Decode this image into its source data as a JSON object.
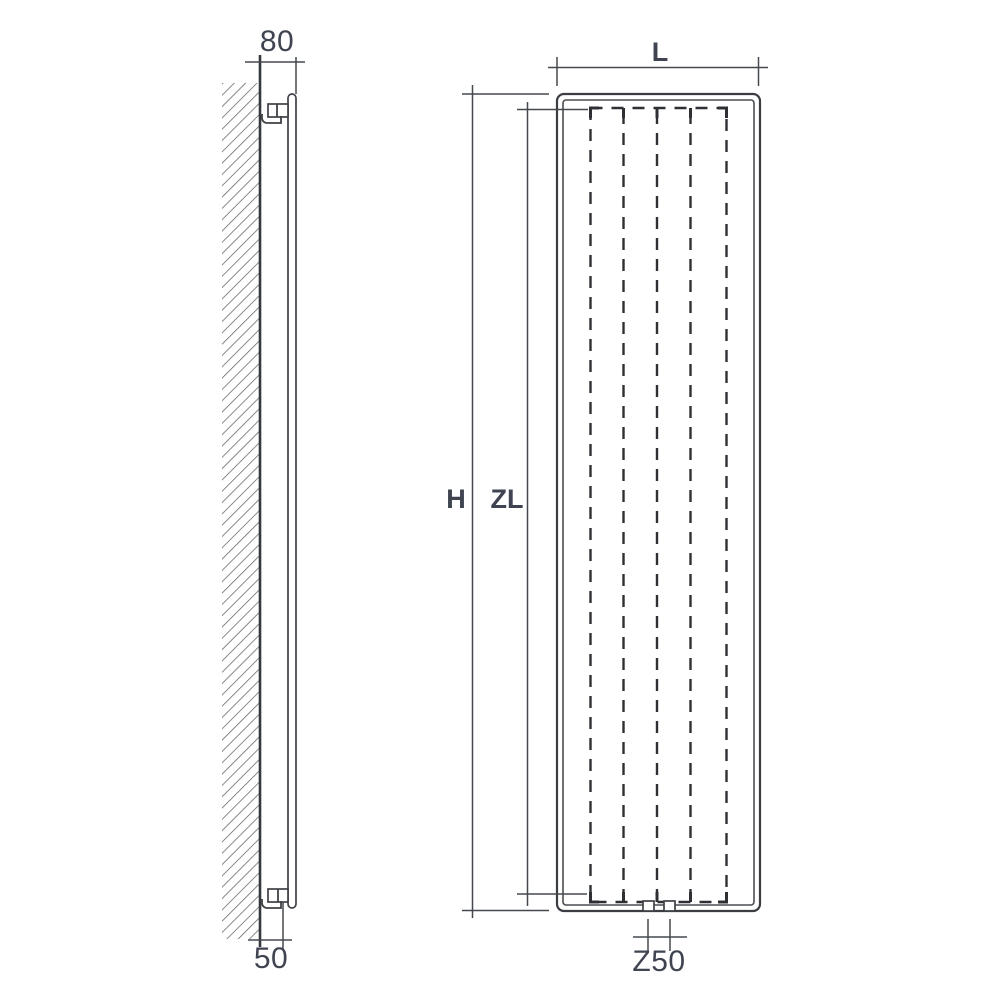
{
  "drawing": {
    "type": "radiator-technical-dimension-drawing",
    "colors": {
      "background": "#ffffff",
      "line": "#3e4146",
      "dashed_element": "#2f3033",
      "dimension_line": "#45494e",
      "label_text": "#3f4450",
      "wall_hatch": "#5f6267"
    },
    "side_view": {
      "depth_label": "80",
      "wall_clearance_label": "50"
    },
    "front_view": {
      "width_label": "L",
      "height_label": "H",
      "element_length_label": "ZL",
      "connection_spacing_label": "Z50"
    }
  }
}
